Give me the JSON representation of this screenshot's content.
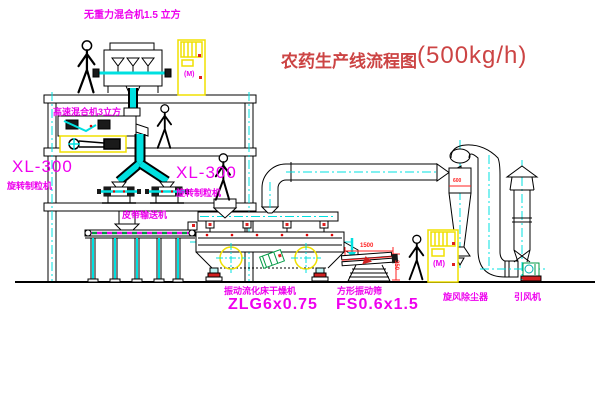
{
  "title": {
    "text": "农药生产线流程图",
    "capacity": "(500kg/h)"
  },
  "labels": {
    "top_mixer": "无重力混合机1.5 立方",
    "floor2_mixer": "高速混合机3立方",
    "xl300_left": "XL-300",
    "granulator_left": "旋转制粒机",
    "xl300_mid": "XL-300",
    "granulator_mid": "旋转制粒机",
    "belt_conveyor": "皮带输送机",
    "dryer_name": "振动流化床干燥机",
    "dryer_model": "ZLG6x0.75",
    "sieve_name": "方形振动筛",
    "sieve_model": "FS0.6x1.5",
    "cyclone_name": "旋风除尘器",
    "fan_name": "引风机"
  },
  "dimensions": {
    "sieve_length": "1500",
    "sieve_height": "350",
    "cyclone_line": "600"
  },
  "cabinet": {
    "motor_glyph": "(M)"
  },
  "colors": {
    "label_magenta": "#ee00ee",
    "dimension_red": "#ff2222",
    "title_red": "#cc4444",
    "centerline_cyan": "#00e0e0",
    "cabinet_yellow": "#f0e000",
    "accent_green": "#009944"
  }
}
